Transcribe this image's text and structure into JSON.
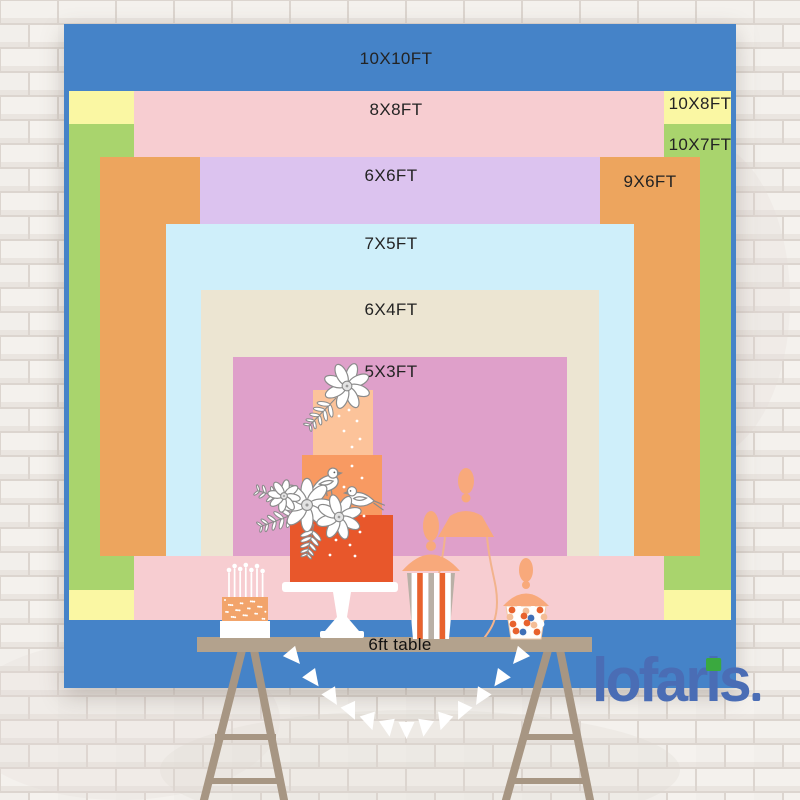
{
  "backdrop": {
    "sizes": [
      {
        "label": "10X10FT",
        "color": "#4583c8",
        "x": 64,
        "y": 24,
        "w": 672,
        "h": 664,
        "label_x": 396,
        "label_y": 59
      },
      {
        "label": "10X8FT",
        "color": "#faf7a3",
        "x": 69,
        "y": 91,
        "w": 662,
        "h": 529,
        "label_x": 700,
        "label_y": 104
      },
      {
        "label": "10X7FT",
        "color": "#a9d46d",
        "x": 69,
        "y": 124,
        "w": 662,
        "h": 466,
        "label_x": 700,
        "label_y": 145
      },
      {
        "label": "8X8FT",
        "color": "#f7cdd1",
        "x": 134,
        "y": 91,
        "w": 530,
        "h": 529,
        "label_x": 396,
        "label_y": 110
      },
      {
        "label": "9X6FT",
        "color": "#eda55e",
        "x": 100,
        "y": 157,
        "w": 600,
        "h": 399,
        "label_x": 650,
        "label_y": 182
      },
      {
        "label": "6X6FT",
        "color": "#dcc3ef",
        "x": 200,
        "y": 157,
        "w": 400,
        "h": 399,
        "label_x": 391,
        "label_y": 176
      },
      {
        "label": "7X5FT",
        "color": "#cfeffa",
        "x": 166,
        "y": 224,
        "w": 468,
        "h": 332,
        "label_x": 391,
        "label_y": 244
      },
      {
        "label": "6X4FT",
        "color": "#ece5d2",
        "x": 201,
        "y": 290,
        "w": 398,
        "h": 266,
        "label_x": 391,
        "label_y": 310
      },
      {
        "label": "5X3FT",
        "color": "#dfa0ca",
        "x": 233,
        "y": 357,
        "w": 334,
        "h": 199,
        "label_x": 391,
        "label_y": 372
      }
    ]
  },
  "table": {
    "label": "6ft table",
    "label_x": 400,
    "label_y": 645,
    "color": "#b3a28d",
    "leg_color": "#a79683"
  },
  "brand": {
    "name": "lofaris",
    "color": "#4a6db5",
    "accent_green": "#3aa93f"
  },
  "palette": {
    "wall_brick": "#f4f1ed",
    "wall_mortar": "#dcd5cf",
    "label_text": "#232323",
    "cake_top": "#fcc39a",
    "cake_middle": "#f89a62",
    "cake_bottom": "#e8572b",
    "peach_lid": "#f8a97b",
    "jar_outline": "#f2b38c",
    "stripe_orange": "#e8622d",
    "stripe_gray": "#b9b0a6",
    "mini_cake_orange": "#f2a46b",
    "white": "#ffffff",
    "outline_gray": "#8b8b8b",
    "candy_blue": "#3f6fb6",
    "candy_peach": "#f4bd96"
  }
}
